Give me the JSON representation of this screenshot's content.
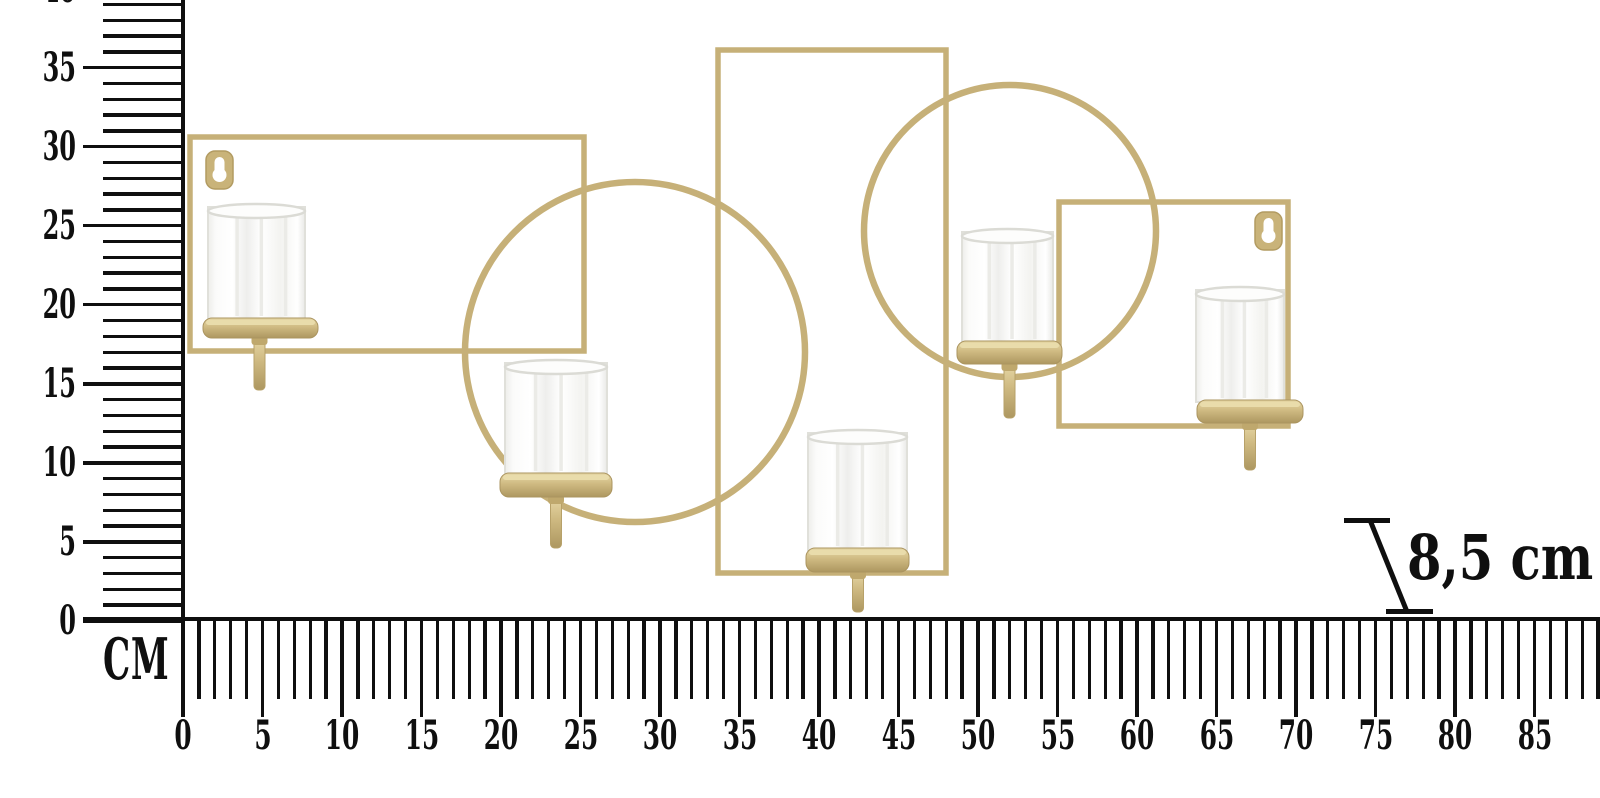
{
  "title": "Gold wall candle holder - dimension diagram",
  "vertical_ruler": {
    "unit_label": "CM",
    "tick_labels": [
      "0",
      "5",
      "10",
      "15",
      "20",
      "25",
      "30",
      "35",
      "40"
    ],
    "min_cm": 0,
    "max_cm": 39,
    "label_step_cm": 5
  },
  "horizontal_ruler": {
    "tick_labels": [
      "0",
      "5",
      "10",
      "15",
      "20",
      "25",
      "30",
      "35",
      "40",
      "45",
      "50",
      "55",
      "60",
      "65",
      "70",
      "75",
      "80",
      "85"
    ],
    "min_cm": 0,
    "max_cm": 89,
    "label_step_cm": 5
  },
  "depth_annotation": {
    "text": "8,5 cm"
  },
  "product": {
    "description": "Gold metal wall-mounted candle holder: overlapping rectangles, circles and a square, five glass tealight cups on stems, two keyhole wall hangers",
    "cup_count": 5,
    "colors": {
      "gold": "#c6b078",
      "gold_light": "#e6d9a8",
      "gold_dark": "#ad9760",
      "glass_edge": "#dedeD8",
      "ruler_black": "#0f0f0f",
      "background": "#ffffff"
    }
  }
}
